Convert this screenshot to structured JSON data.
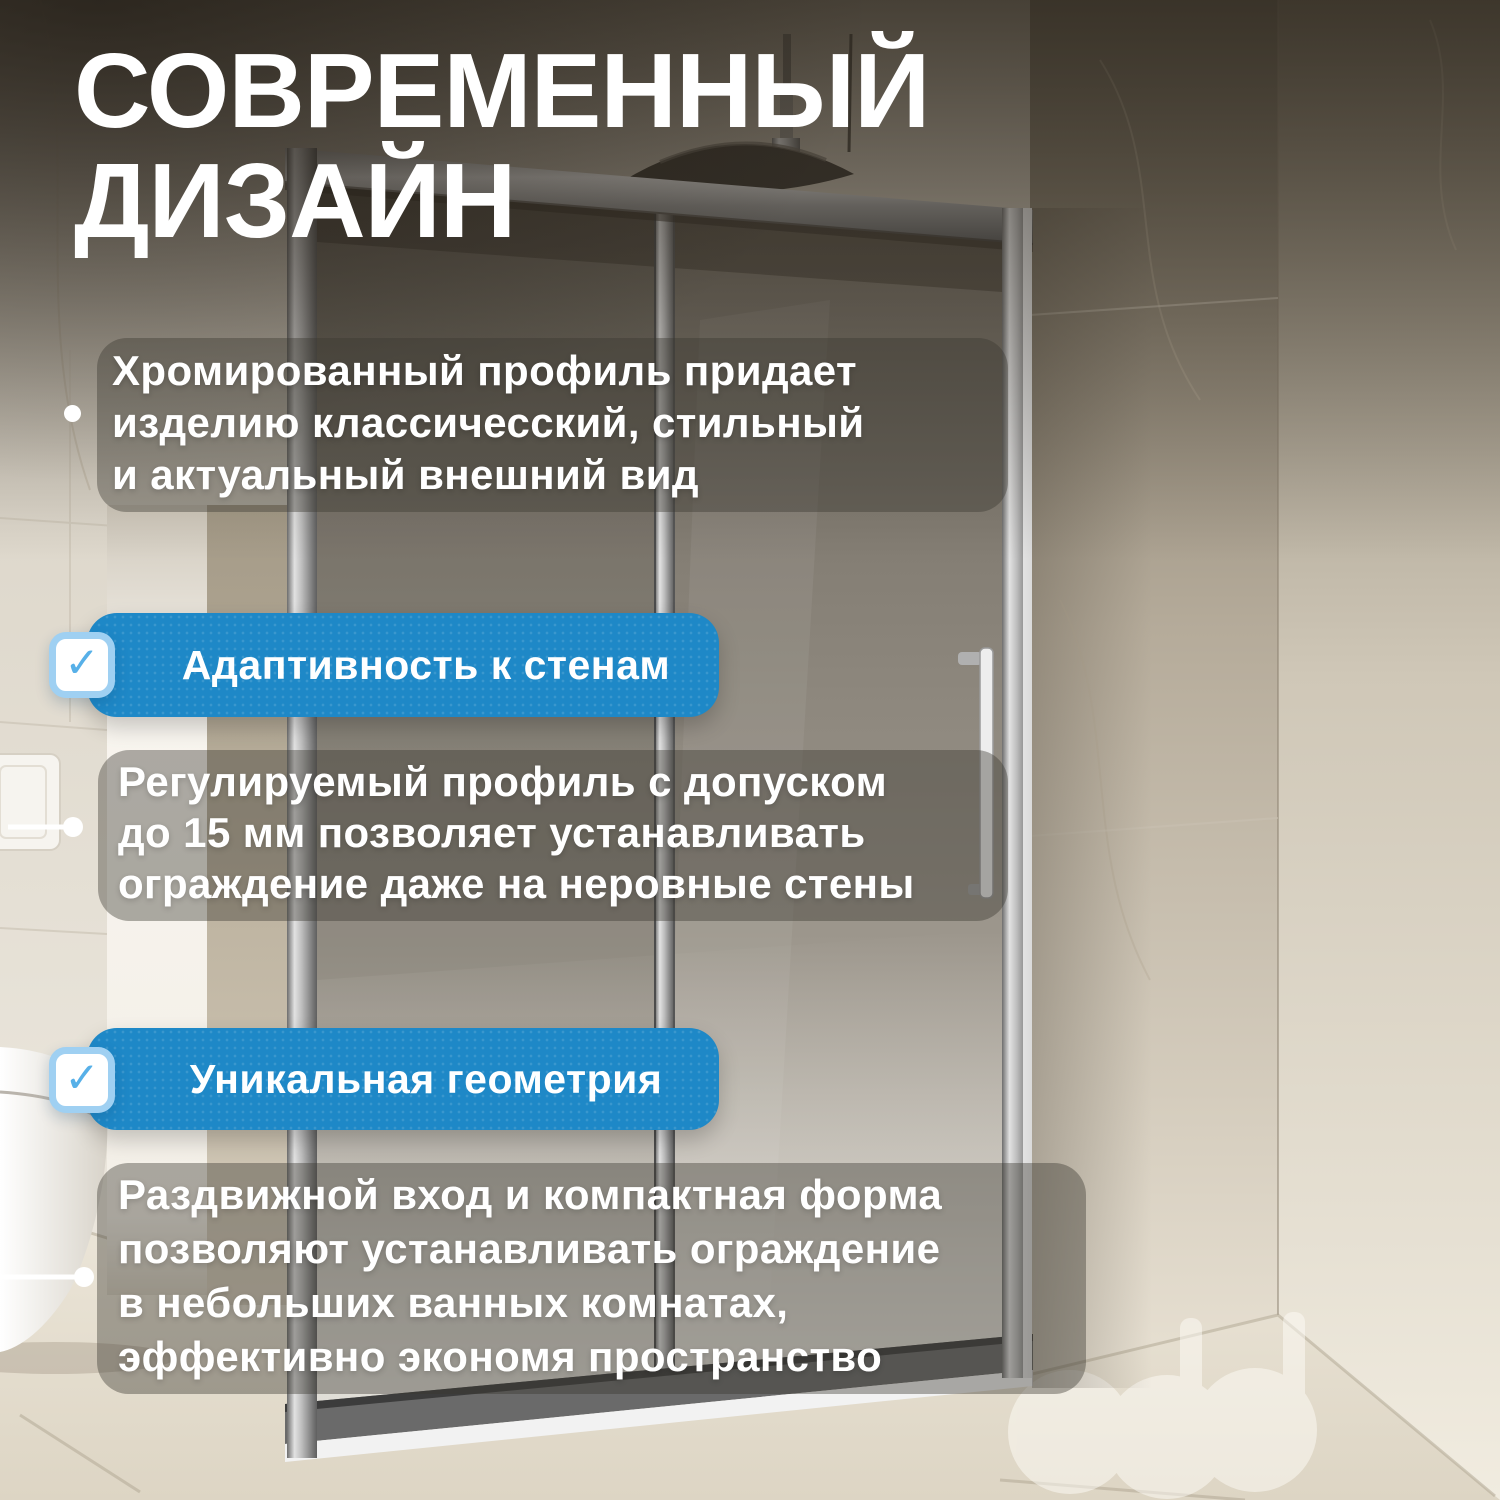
{
  "colors": {
    "banner_blue": "#1e88c7",
    "checkbox_border": "#9fd0f2",
    "checkmark_blue": "#57b0e8",
    "text_white": "#ffffff",
    "overlay_box": "rgba(58,54,47,0.40)"
  },
  "title": {
    "lines": [
      "СОВРЕМЕННЫЙ",
      "ДИЗАЙН"
    ]
  },
  "intro": {
    "bullet_icon": "dot",
    "lines": [
      "Хромированный профиль придает",
      "изделию классичесский, стильный",
      "и актуальный внешний вид"
    ]
  },
  "features": [
    {
      "check_icon": "✓",
      "label": "Адаптивность к стенам",
      "description_lines": [
        "Регулируемый профиль с допуском",
        "до 15 мм позволяет устанавливать",
        "ограждение даже на неровные стены"
      ]
    },
    {
      "check_icon": "✓",
      "label": "Уникальная геометрия",
      "description_lines": [
        "Раздвижной вход и компактная форма",
        "позволяют устанавливать ограждение",
        "в небольших ванных комнатах,",
        "эффективно экономя пространство"
      ]
    }
  ]
}
